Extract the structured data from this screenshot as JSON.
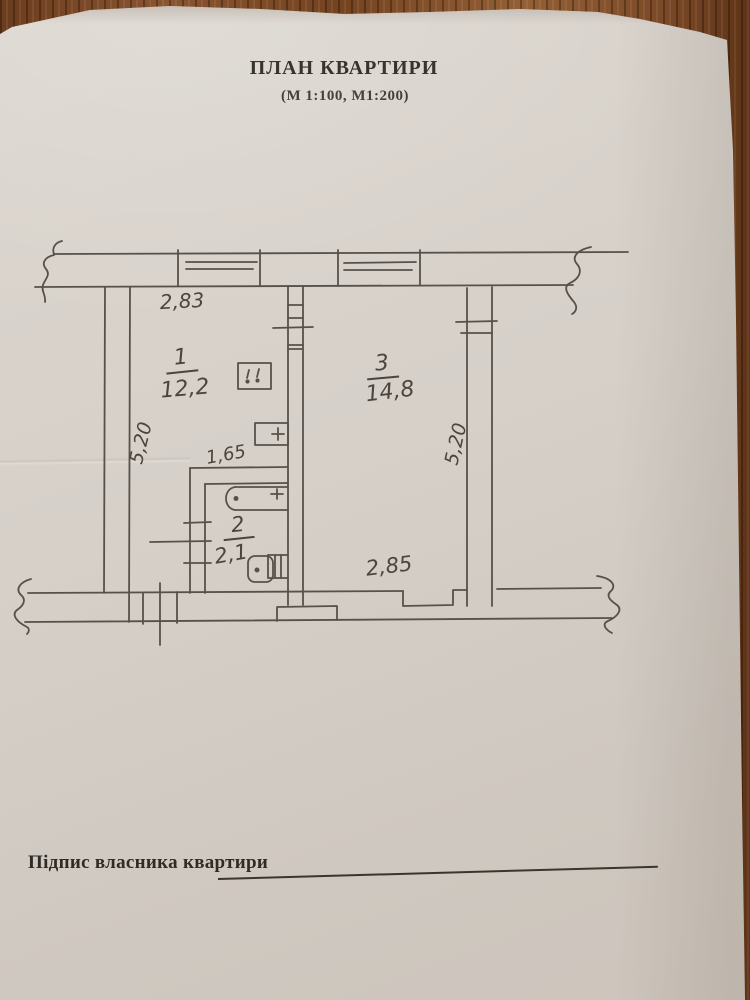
{
  "document": {
    "title": "ПЛАН КВАРТИРИ",
    "subtitle": "(М 1:100, М1:200)",
    "signature_label": "Підпис власника квартири"
  },
  "plan": {
    "rooms": [
      {
        "number": "1",
        "area": "12,2"
      },
      {
        "number": "2",
        "area": "2,1"
      },
      {
        "number": "3",
        "area": "14,8"
      }
    ],
    "dimensions": {
      "room1_width": "2,83",
      "room1_depth": "5,20",
      "bathroom_width": "1,65",
      "room3_width": "2,85",
      "room3_depth": "5,20"
    },
    "symbols": [
      "window",
      "door-opening",
      "stove",
      "sink",
      "bathtub",
      "toilet",
      "wall-break"
    ]
  },
  "colors": {
    "paper": "#d6d0c9",
    "wood_table": "#7c4a27",
    "ink": "#57514a",
    "handwriting": "#4b453d"
  }
}
